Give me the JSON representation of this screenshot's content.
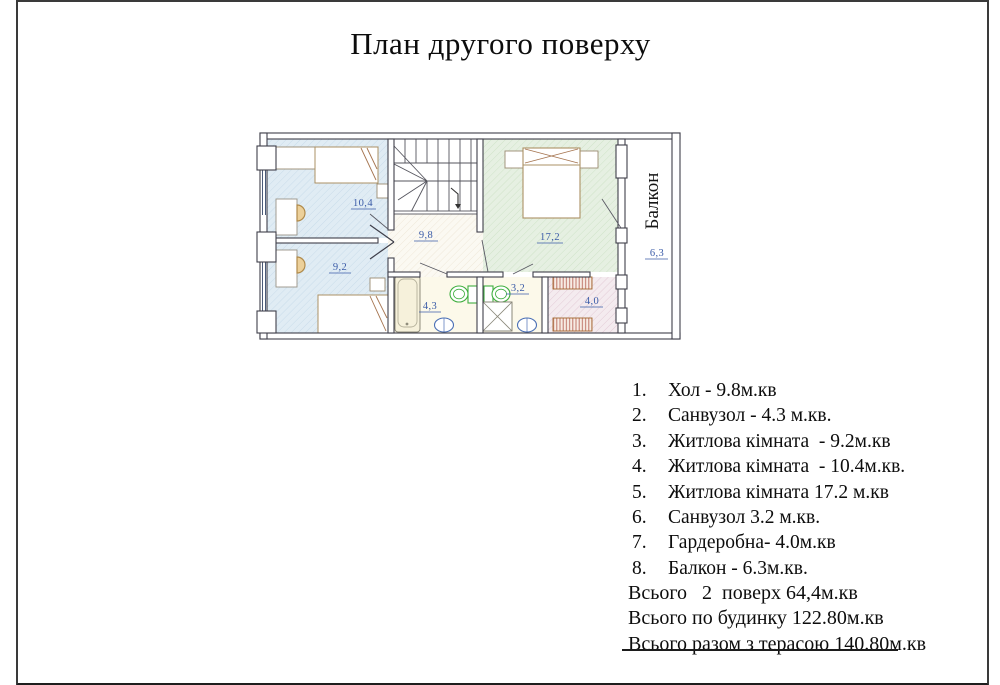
{
  "title": "План другого поверху",
  "plan": {
    "balcony_label": "Балкон",
    "rooms": {
      "room_104": "10,4",
      "room_92": "9,2",
      "hall": "9,8",
      "room_172": "17,2",
      "bath_43": "4,3",
      "bath_32": "3,2",
      "wardrobe": "4,0",
      "balcony_area": "6,3"
    },
    "colors": {
      "room_blue": "#e0ecf4",
      "room_green": "#e6f0e2",
      "wardrobe_pink": "#f2e9ef",
      "hall_cream": "#fbf9f2",
      "bath_cream": "#fcf9ea",
      "wall": "#3f3f4a",
      "label_blue": "#3b5ca8",
      "furniture_tan": "#ab9164",
      "fixture_green": "#3fae3f",
      "fixture_blue": "#4a6fb5"
    }
  },
  "legend": {
    "items": [
      {
        "num": "1.",
        "text": "Хол - 9.8м.кв"
      },
      {
        "num": "2.",
        "text": "Санвузол - 4.3 м.кв."
      },
      {
        "num": "3.",
        "text": "Житлова кімната  - 9.2м.кв"
      },
      {
        "num": "4.",
        "text": "Житлова кімната  - 10.4м.кв."
      },
      {
        "num": "5.",
        "text": "Житлова кімната 17.2 м.кв"
      },
      {
        "num": "6.",
        "text": "Санвузол 3.2 м.кв."
      },
      {
        "num": "7.",
        "text": "Гардеробна- 4.0м.кв"
      },
      {
        "num": "8.",
        "text": "Балкон - 6.3м.кв."
      }
    ],
    "totals": [
      "Всього   2  поверх 64,4м.кв",
      "Всього по будинку 122.80м.кв",
      "Всього разом з терасою 140.80м.кв"
    ]
  }
}
